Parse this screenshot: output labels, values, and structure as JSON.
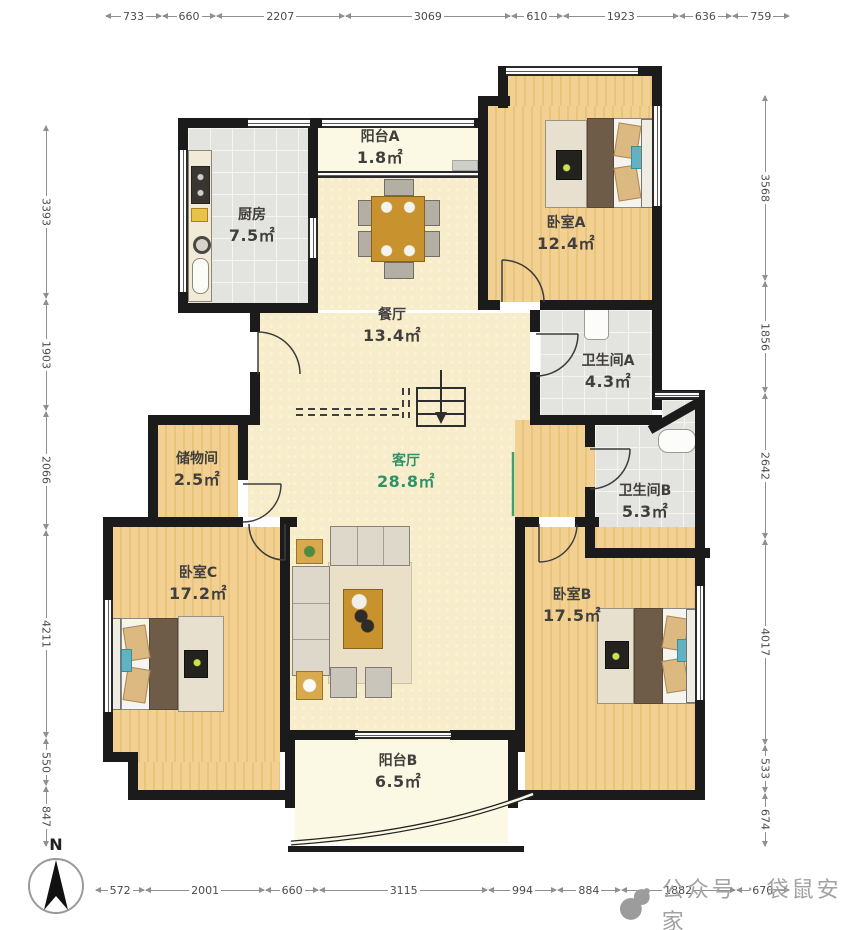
{
  "plan": {
    "compass_label": "N",
    "watermark": "公众号 · 袋鼠安家",
    "rooms": [
      {
        "id": "balcony_a",
        "name": "阳台A",
        "area": "1.8㎡"
      },
      {
        "id": "kitchen",
        "name": "厨房",
        "area": "7.5㎡"
      },
      {
        "id": "bedroom_a",
        "name": "卧室A",
        "area": "12.4㎡"
      },
      {
        "id": "dining",
        "name": "餐厅",
        "area": "13.4㎡"
      },
      {
        "id": "bath_a",
        "name": "卫生间A",
        "area": "4.3㎡"
      },
      {
        "id": "storage",
        "name": "储物间",
        "area": "2.5㎡"
      },
      {
        "id": "living",
        "name": "客厅",
        "area": "28.8㎡"
      },
      {
        "id": "bath_b",
        "name": "卫生间B",
        "area": "5.3㎡"
      },
      {
        "id": "bedroom_c",
        "name": "卧室C",
        "area": "17.2㎡"
      },
      {
        "id": "bedroom_b",
        "name": "卧室B",
        "area": "17.5㎡"
      },
      {
        "id": "balcony_b",
        "name": "阳台B",
        "area": "6.5㎡"
      }
    ],
    "dimensions_mm": {
      "top": [
        "733",
        "660",
        "2207",
        "3069",
        "610",
        "1923",
        "636",
        "759"
      ],
      "bottom": [
        "572",
        "2001",
        "660",
        "3115",
        "994",
        "884",
        "1882",
        "670"
      ],
      "left": [
        "3393",
        "1903",
        "2066",
        "4211",
        "550",
        "847"
      ],
      "right": [
        "3568",
        "1856",
        "2642",
        "4017",
        "533",
        "674"
      ]
    },
    "colors": {
      "wall": "#1b1b1b",
      "wood_floor": "#f0cd8e",
      "tile_floor": "#e3e3e0",
      "open_floor": "#f8edca",
      "balcony_floor": "#fbf9e3",
      "living_label_green": "#2f9168",
      "dim_text": "#4c4c4c",
      "watermark_gray": "#a2a2a2"
    }
  }
}
